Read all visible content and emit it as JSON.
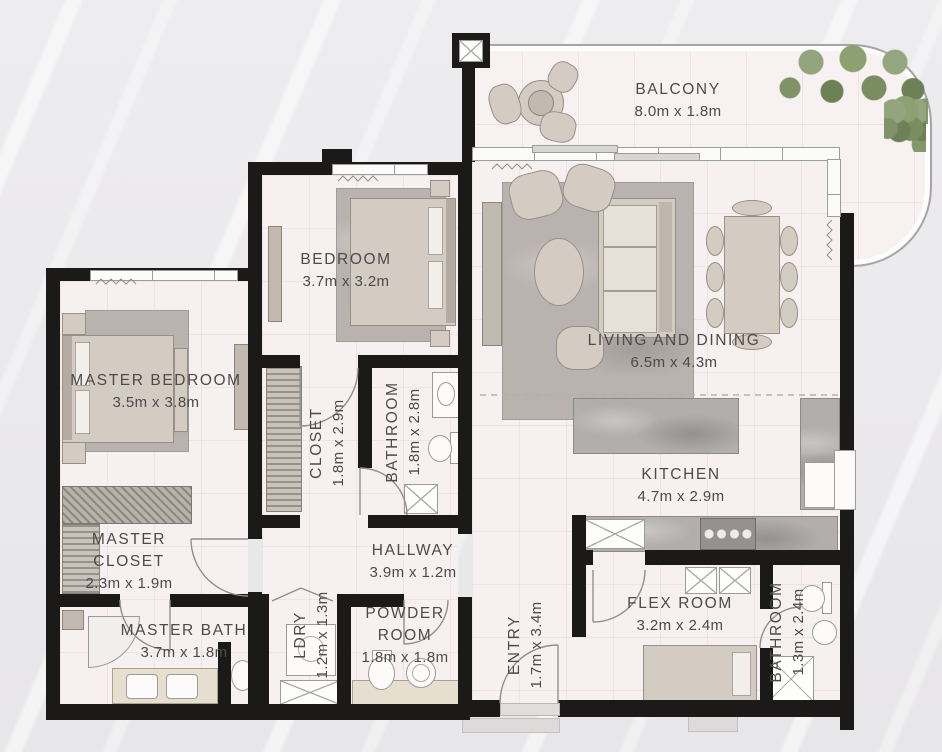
{
  "plan": {
    "title": "Apartment floor plan",
    "rooms": {
      "balcony": {
        "name": "BALCONY",
        "dims": "8.0m x 1.8m"
      },
      "bedroom": {
        "name": "BEDROOM",
        "dims": "3.7m x 3.2m"
      },
      "master_bedroom": {
        "name": "MASTER BEDROOM",
        "dims": "3.5m x 3.8m"
      },
      "living_dining": {
        "name": "LIVING AND DINING",
        "dims": "6.5m x 4.3m"
      },
      "closet": {
        "name": "CLOSET",
        "dims": "1.8m x 2.9m"
      },
      "bathroom": {
        "name": "BATHROOM",
        "dims": "1.8m x 2.8m"
      },
      "kitchen": {
        "name": "KITCHEN",
        "dims": "4.7m x 2.9m"
      },
      "master_closet": {
        "name": "MASTER CLOSET",
        "dims": "2.3m x 1.9m"
      },
      "hallway": {
        "name": "HALLWAY",
        "dims": "3.9m x 1.2m"
      },
      "master_bath": {
        "name": "MASTER BATH",
        "dims": "3.7m x 1.8m"
      },
      "laundry": {
        "name": "LDRY",
        "dims": "1.2m x 1.3m"
      },
      "powder_room": {
        "name": "POWDER ROOM",
        "dims": "1.8m x 1.8m"
      },
      "entry": {
        "name": "ENTRY",
        "dims": "1.7m x 3.4m"
      },
      "flex_room": {
        "name": "FLEX ROOM",
        "dims": "3.2m x 2.4m"
      },
      "bathroom_2": {
        "name": "BATHROOM",
        "dims": "1.3m x 2.4m"
      }
    },
    "colors": {
      "wall": "#1b1a19",
      "floor": "#f7f0f0",
      "furniture": "#d4ccc3",
      "greenery": "#7f9268",
      "text": "#4c4b4a",
      "background": "#ebeaec"
    }
  }
}
